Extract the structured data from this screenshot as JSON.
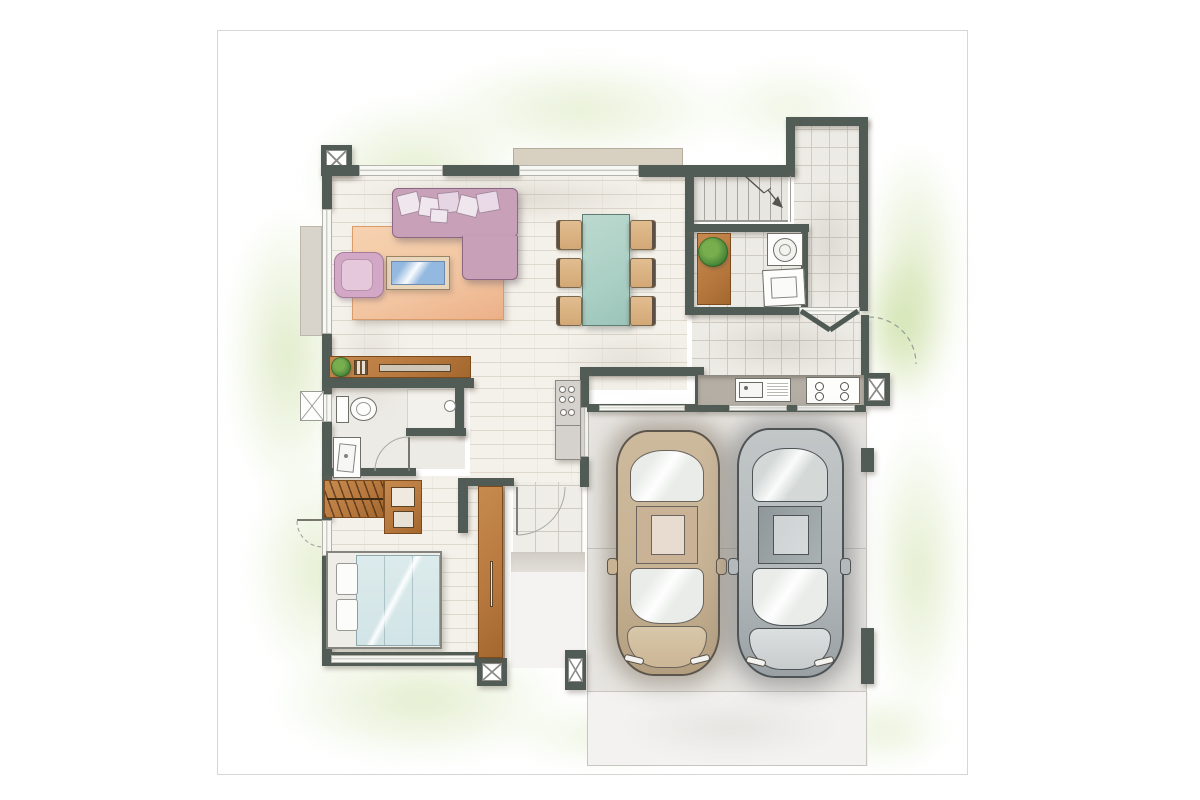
{
  "title": "Hand-drawn watercolor residential floor plan, top view",
  "style": "architectural sketch with watercolor washes, no text labels",
  "palette": {
    "paper": "#ffffff",
    "paperline": "#d6d6d6",
    "green": "#cde0a8",
    "wall": "#515c56",
    "brick": "#f4f1ea",
    "brickline": "#ded8cd",
    "tile": "#edebe5",
    "tileline": "#cfcbc2",
    "porch": "#efede8",
    "garage": "#e7e5e1",
    "drive": "#f3f2f0",
    "concrete": "#c8c5bf",
    "wood": "#b8793f",
    "wooddark": "#7c4a1d",
    "sofa": "#c8a1b9",
    "sofaline": "#8d6884",
    "pillow": "#f0e7ee",
    "rug": "#f2c5a1",
    "rugline": "#d99b69",
    "glass": "#94b9e0",
    "teal": "#aacfc4",
    "tealline": "#5f7d72",
    "chair": "#d3a876",
    "chairline": "#77684e",
    "counter": "#b4aea5",
    "steel": "#6f6f6a",
    "bedblue": "#d2e4e6",
    "bedline": "#8da9ad",
    "plantdark": "#3c7c33",
    "plantlight": "#79ae4e",
    "canopy": "#d8d0c1",
    "terrace": "#d9d4cb",
    "cartan": "#c8b395",
    "cartandark": "#5d564c",
    "cargray": "#b4babc",
    "cargraydark": "#4e5356",
    "ink": "#8f8f89"
  },
  "inventory": {
    "rooms": [
      "living-room",
      "dining-area",
      "kitchen",
      "laundry-room",
      "entry-hall",
      "staircase",
      "bathroom",
      "bedroom",
      "wardrobe-corner",
      "front-porch",
      "double-garage",
      "driveway"
    ],
    "fixtures": [
      "l-shaped-sectional-sofa",
      "six-throw-pillows",
      "area-rug",
      "glass-coffee-table",
      "armchair",
      "dining-table",
      "six-dining-chairs",
      "console-shelf-with-plant",
      "tall-cabinet-fridge",
      "kitchen-sink-with-drainboard",
      "four-burner-cooktop",
      "laundry-bench-with-plant",
      "washing-machine",
      "dryer",
      "toilet",
      "vanity-sink",
      "shower-enclosure",
      "double-bed-with-two-pillows",
      "closet-with-hanging-clothes",
      "dresser",
      "wood-sliding-door",
      "structural-columns-x4"
    ],
    "vehicles": [
      "tan-car-top-view",
      "gray-car-top-view"
    ],
    "door_symbols": [
      "double-entry-door-v",
      "exterior-gate-swing-dashed",
      "bathroom-door-swing",
      "bedroom-exterior-door-swing",
      "front-door-swing",
      "stair-direction-arrow"
    ]
  }
}
